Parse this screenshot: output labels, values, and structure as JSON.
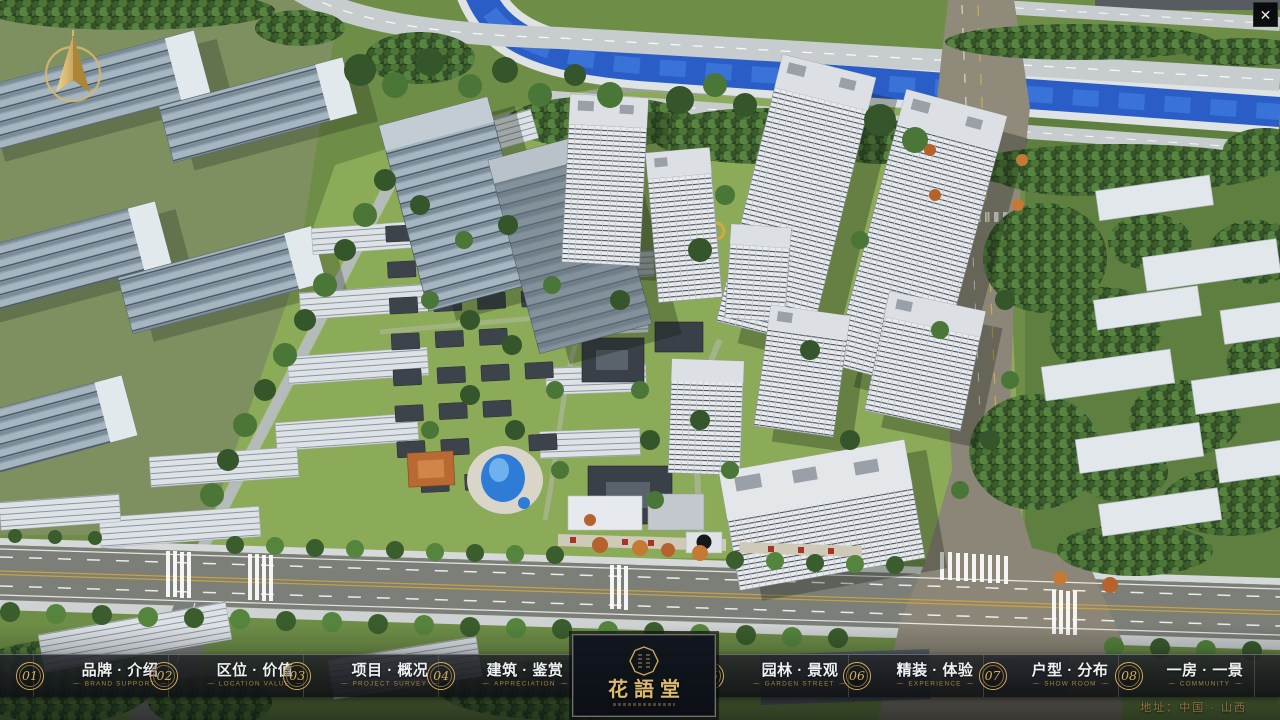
{
  "window": {
    "close_icon": "✕"
  },
  "colors": {
    "gold": "#d3ad62",
    "gold_dim": "#a5833f",
    "bar_background": "#14161a",
    "logo_panel_background": "#0d1218",
    "river_blue": "#2a5ec6",
    "accent_red": "#a83428"
  },
  "nav": {
    "items": [
      {
        "num": "01",
        "zh": "品牌 · 介绍",
        "en": "BRAND SUPPORT"
      },
      {
        "num": "02",
        "zh": "区位 · 价值",
        "en": "LOCATION VALUE"
      },
      {
        "num": "03",
        "zh": "项目 · 概况",
        "en": "PROJECT SURVEY"
      },
      {
        "num": "04",
        "zh": "建筑 · 鉴赏",
        "en": "APPRECIATION"
      },
      {
        "num": "05",
        "zh": "园林 · 景观",
        "en": "GARDEN STREET"
      },
      {
        "num": "06",
        "zh": "精装 · 体验",
        "en": "EXPERIENCE"
      },
      {
        "num": "07",
        "zh": "户型 · 分布",
        "en": "SHOW ROOM"
      },
      {
        "num": "08",
        "zh": "一房 · 一景",
        "en": "COMMUNITY"
      }
    ]
  },
  "logo": {
    "title": "花語堂"
  },
  "footer": {
    "address": "地址：中国 · 山西"
  }
}
